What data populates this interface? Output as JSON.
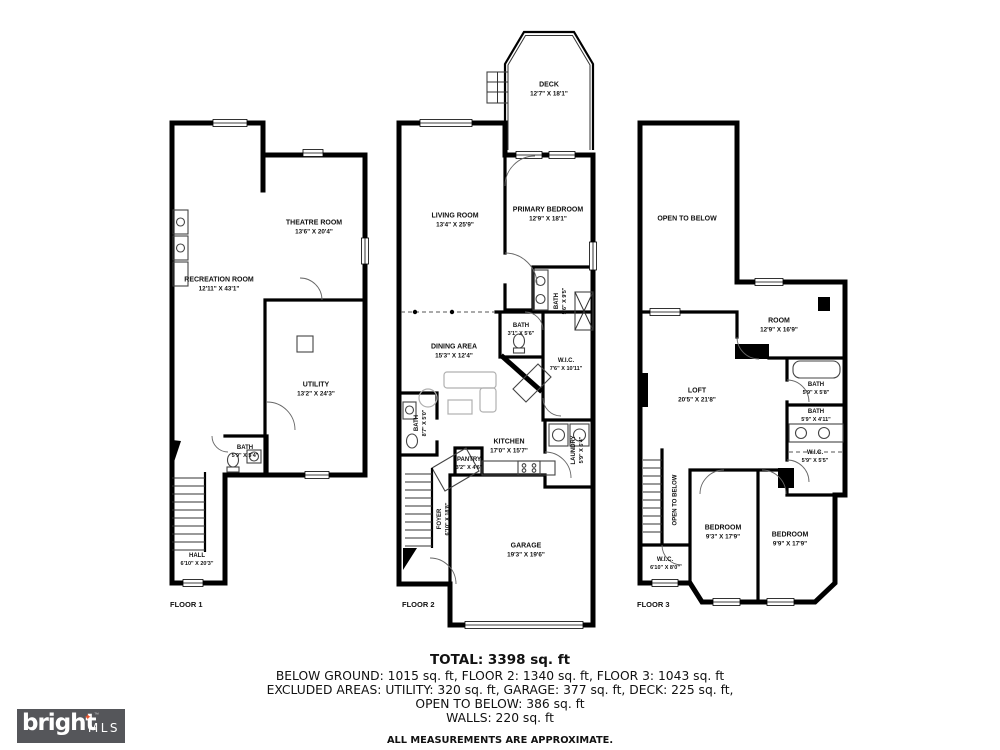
{
  "page": {
    "background": "#ffffff"
  },
  "logo": {
    "brand": "bright",
    "star": "✦",
    "tm": "™",
    "suffix": "MLS",
    "bg_color": "#55565A",
    "star_color": "#E8542D",
    "text_color": "#FFFFFF"
  },
  "summary": {
    "total": "TOTAL: 3398 sq. ft",
    "line1": "BELOW GROUND: 1015 sq. ft, FLOOR 2: 1340 sq. ft, FLOOR 3: 1043 sq. ft",
    "line2": "EXCLUDED AREAS: UTILITY: 320 sq. ft, GARAGE: 377 sq. ft, DECK: 225 sq. ft,",
    "line3": "OPEN TO BELOW: 386 sq. ft",
    "line4": "WALLS: 220 sq. ft",
    "disclaimer": "ALL MEASUREMENTS ARE APPROXIMATE."
  },
  "floors": [
    {
      "label": "FLOOR 1",
      "rooms": [
        {
          "name": "THEATRE ROOM",
          "dims": "13'6\" X 20'4\""
        },
        {
          "name": "RECREATION ROOM",
          "dims": "12'11\" X 43'1\""
        },
        {
          "name": "UTILITY",
          "dims": "13'2\" X 24'3\""
        },
        {
          "name": "BATH",
          "dims": "5'9\" X 5'4\""
        },
        {
          "name": "HALL",
          "dims": "6'10\" X 20'3\""
        }
      ]
    },
    {
      "label": "FLOOR 2",
      "rooms": [
        {
          "name": "DECK",
          "dims": "12'7\" X 18'1\""
        },
        {
          "name": "LIVING ROOM",
          "dims": "13'4\" X 25'9\""
        },
        {
          "name": "PRIMARY BEDROOM",
          "dims": "12'9\" X 18'1\""
        },
        {
          "name": "BATH",
          "dims": "5'6\" X 9'5\""
        },
        {
          "name": "DINING AREA",
          "dims": "15'3\" X 12'4\""
        },
        {
          "name": "BATH",
          "dims": "3'1\" X 5'6\""
        },
        {
          "name": "W.I.C.",
          "dims": "7'6\" X 10'11\""
        },
        {
          "name": "BATH",
          "dims": "8'7\" X 5'0\""
        },
        {
          "name": "KITCHEN",
          "dims": "17'0\" X 15'7\""
        },
        {
          "name": "PANTRY",
          "dims": "3'2\" X 4'6\""
        },
        {
          "name": "LAUNDRY",
          "dims": "5'9\" X 6'4\""
        },
        {
          "name": "FOYER",
          "dims": "6'10\" X 18'8\""
        },
        {
          "name": "GARAGE",
          "dims": "19'3\" X 19'6\""
        }
      ]
    },
    {
      "label": "FLOOR 3",
      "rooms": [
        {
          "name": "OPEN TO BELOW",
          "dims": ""
        },
        {
          "name": "ROOM",
          "dims": "12'9\" X 16'9\""
        },
        {
          "name": "LOFT",
          "dims": "20'5\" X 21'8\""
        },
        {
          "name": "BATH",
          "dims": "5'9\" X 5'8\""
        },
        {
          "name": "BATH",
          "dims": "5'9\" X 4'11\""
        },
        {
          "name": "W.I.C.",
          "dims": "5'9\" X 5'5\""
        },
        {
          "name": "OPEN TO BELOW",
          "dims": ""
        },
        {
          "name": "W.I.C.",
          "dims": "6'10\" X 8'0\""
        },
        {
          "name": "BEDROOM",
          "dims": "9'3\" X 17'9\""
        },
        {
          "name": "BEDROOM",
          "dims": "9'9\" X 17'9\""
        }
      ]
    }
  ]
}
